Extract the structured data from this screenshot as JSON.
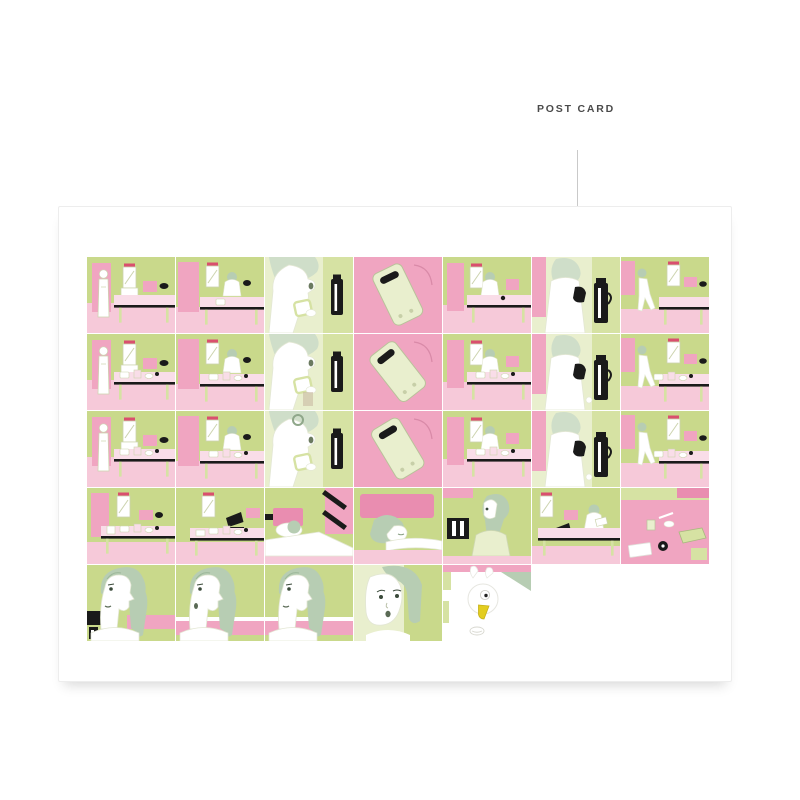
{
  "page": {
    "background": "#ffffff"
  },
  "header": {
    "label": "POST CARD",
    "label_color": "#4a4a4a",
    "line_color": "#c9c9c9"
  },
  "card": {
    "background": "#ffffff",
    "border_color": "#ededed"
  },
  "palette": {
    "green": "#c9d98b",
    "green_mid": "#d6e2a3",
    "green_pale": "#e9efce",
    "pink": "#f0a5c1",
    "pink_light": "#f6c9d9",
    "pink_pale": "#f9dde8",
    "pink_deep": "#e98db0",
    "red_accent": "#d94f6e",
    "black": "#1a1a1a",
    "hair": "#b7cdb3",
    "hair_light": "#cfdec9",
    "yellow": "#e3cd1f",
    "white": "#ffffff"
  },
  "comic": {
    "rows": [
      {
        "panels": [
          {
            "name": "panel-room-vanity",
            "type": "roomVanity",
            "variant": 1
          },
          {
            "name": "panel-room-sitting",
            "type": "roomSitting",
            "variant": 1
          },
          {
            "name": "panel-face-cup",
            "type": "faceCup",
            "variant": 1
          },
          {
            "name": "panel-phone",
            "type": "phone",
            "variant": 1
          },
          {
            "name": "panel-room-desk",
            "type": "roomVanity2",
            "variant": 1
          },
          {
            "name": "panel-woman-flask",
            "type": "womanFlask",
            "variant": 1
          },
          {
            "name": "panel-room-walk",
            "type": "roomWalk",
            "variant": 1
          }
        ]
      },
      {
        "panels": [
          {
            "name": "panel-room-vanity",
            "type": "roomVanity",
            "variant": 2
          },
          {
            "name": "panel-room-sitting",
            "type": "roomSitting",
            "variant": 2
          },
          {
            "name": "panel-face-cup",
            "type": "faceCup",
            "variant": 2
          },
          {
            "name": "panel-phone",
            "type": "phone",
            "variant": 2
          },
          {
            "name": "panel-room-desk",
            "type": "roomVanity2",
            "variant": 2
          },
          {
            "name": "panel-woman-flask",
            "type": "womanFlask",
            "variant": 2
          },
          {
            "name": "panel-room-walk",
            "type": "roomWalk",
            "variant": 2
          }
        ]
      },
      {
        "panels": [
          {
            "name": "panel-room-vanity",
            "type": "roomVanity",
            "variant": 3
          },
          {
            "name": "panel-room-sitting",
            "type": "roomSitting",
            "variant": 3
          },
          {
            "name": "panel-face-cup",
            "type": "faceCup",
            "variant": 3
          },
          {
            "name": "panel-phone",
            "type": "phone",
            "variant": 3
          },
          {
            "name": "panel-room-desk",
            "type": "roomVanity2",
            "variant": 3
          },
          {
            "name": "panel-woman-flask",
            "type": "womanFlask",
            "variant": 3
          },
          {
            "name": "panel-room-walk",
            "type": "roomWalk",
            "variant": 3
          }
        ]
      },
      {
        "panels": [
          {
            "name": "panel-desk-items",
            "type": "roomDeskItems",
            "variant": 1
          },
          {
            "name": "panel-desk-laptop",
            "type": "roomDeskLaptop",
            "variant": 1
          },
          {
            "name": "panel-bed-stairs",
            "type": "bedStairs",
            "variant": 1
          },
          {
            "name": "panel-bed-closeup",
            "type": "bedCloseup",
            "variant": 1
          },
          {
            "name": "panel-waking-up",
            "type": "wakingUp",
            "variant": 1
          },
          {
            "name": "panel-desk-reading",
            "type": "deskScene",
            "variant": 1
          },
          {
            "name": "panel-desk-topview",
            "type": "deskTopview",
            "variant": 1
          }
        ]
      },
      {
        "panels": [
          {
            "name": "panel-face-profile-tv",
            "type": "faceProfile",
            "variant": 1
          },
          {
            "name": "panel-face-profile",
            "type": "faceProfile",
            "variant": 2
          },
          {
            "name": "panel-face-profile",
            "type": "faceProfile",
            "variant": 3
          },
          {
            "name": "panel-face-front",
            "type": "faceFront",
            "variant": 1
          },
          {
            "name": "panel-duck",
            "type": "duck",
            "variant": 1
          },
          {
            "name": "panel-empty",
            "type": "empty",
            "variant": 1
          },
          {
            "name": "panel-empty",
            "type": "empty",
            "variant": 1
          }
        ]
      }
    ]
  }
}
